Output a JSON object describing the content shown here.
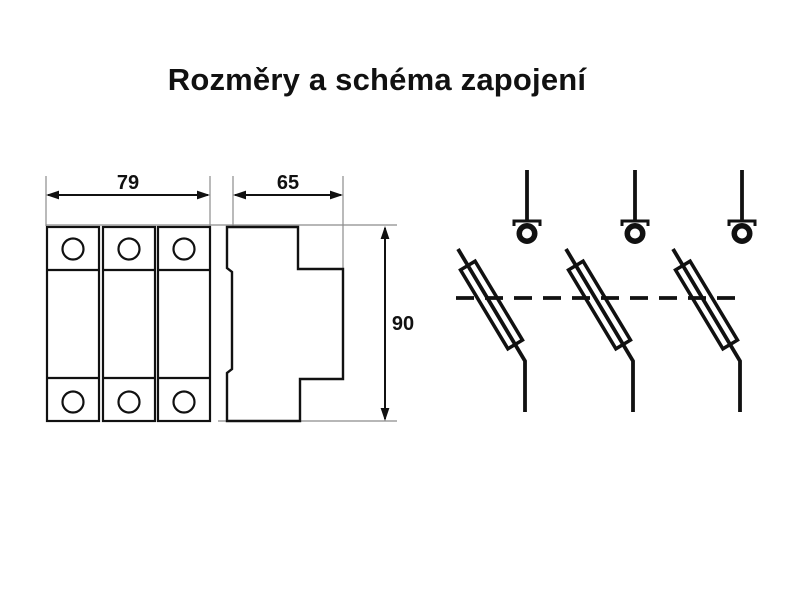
{
  "title": "Rozměry a schéma zapojení",
  "dimensions": {
    "front_width": {
      "value": "79"
    },
    "side_depth": {
      "value": "65"
    },
    "height": {
      "value": "90"
    }
  },
  "drawing": {
    "front_view": {
      "modules": 3,
      "terminals_per_module": 2
    },
    "side_view": {
      "type": "din-rail-profile"
    },
    "schematic": {
      "poles": 3,
      "symbol": "fuse-disconnector",
      "coupling": "dashed-tie-bar"
    }
  },
  "colors": {
    "background": "#ffffff",
    "line": "#111111",
    "extension_line": "#8c8c8c"
  }
}
